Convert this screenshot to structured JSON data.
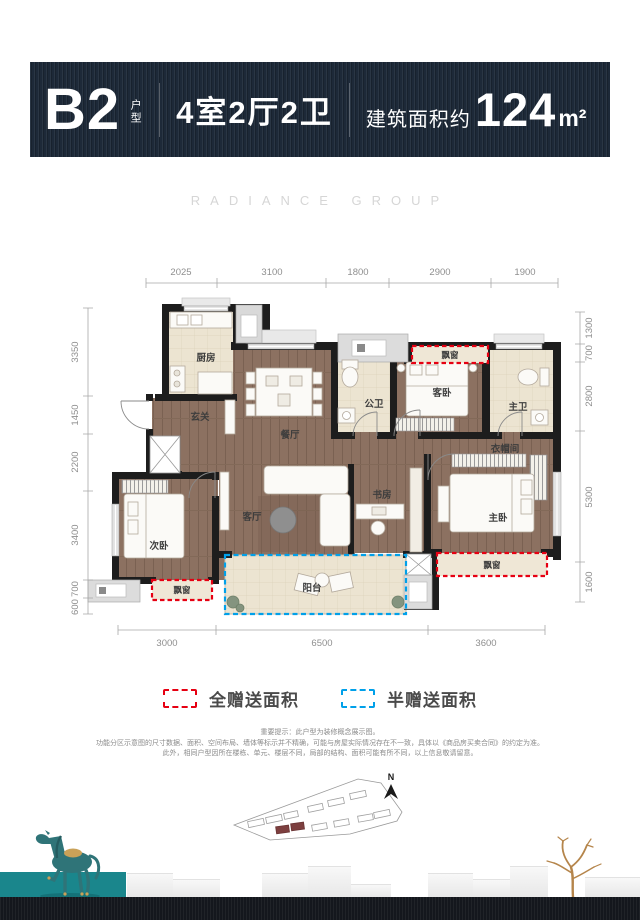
{
  "header": {
    "code": "B2",
    "code_suffix": "户型",
    "layout": "4室2厅2卫",
    "area_prefix": "建筑面积约",
    "area_value": "124",
    "area_unit": "m²"
  },
  "brand": {
    "watermark": "RADIANCE GROUP"
  },
  "plan": {
    "rooms": {
      "kitchen": "厨房",
      "foyer": "玄关",
      "dining": "餐厅",
      "public_bath": "公卫",
      "guest_bedroom": "客卧",
      "master_bath": "主卫",
      "closet": "衣帽间",
      "study": "书房",
      "master_bedroom": "主卧",
      "second_bedroom": "次卧",
      "living": "客厅",
      "balcony": "阳台",
      "bay_window": "飘窗"
    },
    "dims": {
      "top": [
        "2025",
        "3100",
        "1800",
        "2900",
        "1900"
      ],
      "bottom": [
        "3000",
        "6500",
        "3600"
      ],
      "left": [
        "3350",
        "1450",
        "2200",
        "3400",
        "700",
        "600"
      ],
      "right": [
        "1300",
        "700",
        "2800",
        "5300",
        "1600"
      ]
    }
  },
  "legend": {
    "full": "全赠送面积",
    "half": "半赠送面积"
  },
  "disclaimer": {
    "line1": "重要提示：此户型为装修概念展示图。",
    "line2": "功能分区示意图的尺寸数据、面积、空间布局、墙体等标示并不精确，可能与房屋实际情况存在不一致，具体以《商品房买卖合同》的约定为准。",
    "line3": "此外，相同户型因所在楼栋、单元、楼层不同，局部的结构、面积可能有所不同，以上信息敬请留意。"
  },
  "siteplan": {
    "north": "N"
  },
  "colors": {
    "banner_bg": "#1d2938",
    "footer_bg": "#14171d",
    "teal": "#1a868c",
    "gift_full": "#e60012",
    "gift_half": "#00a0e9"
  }
}
